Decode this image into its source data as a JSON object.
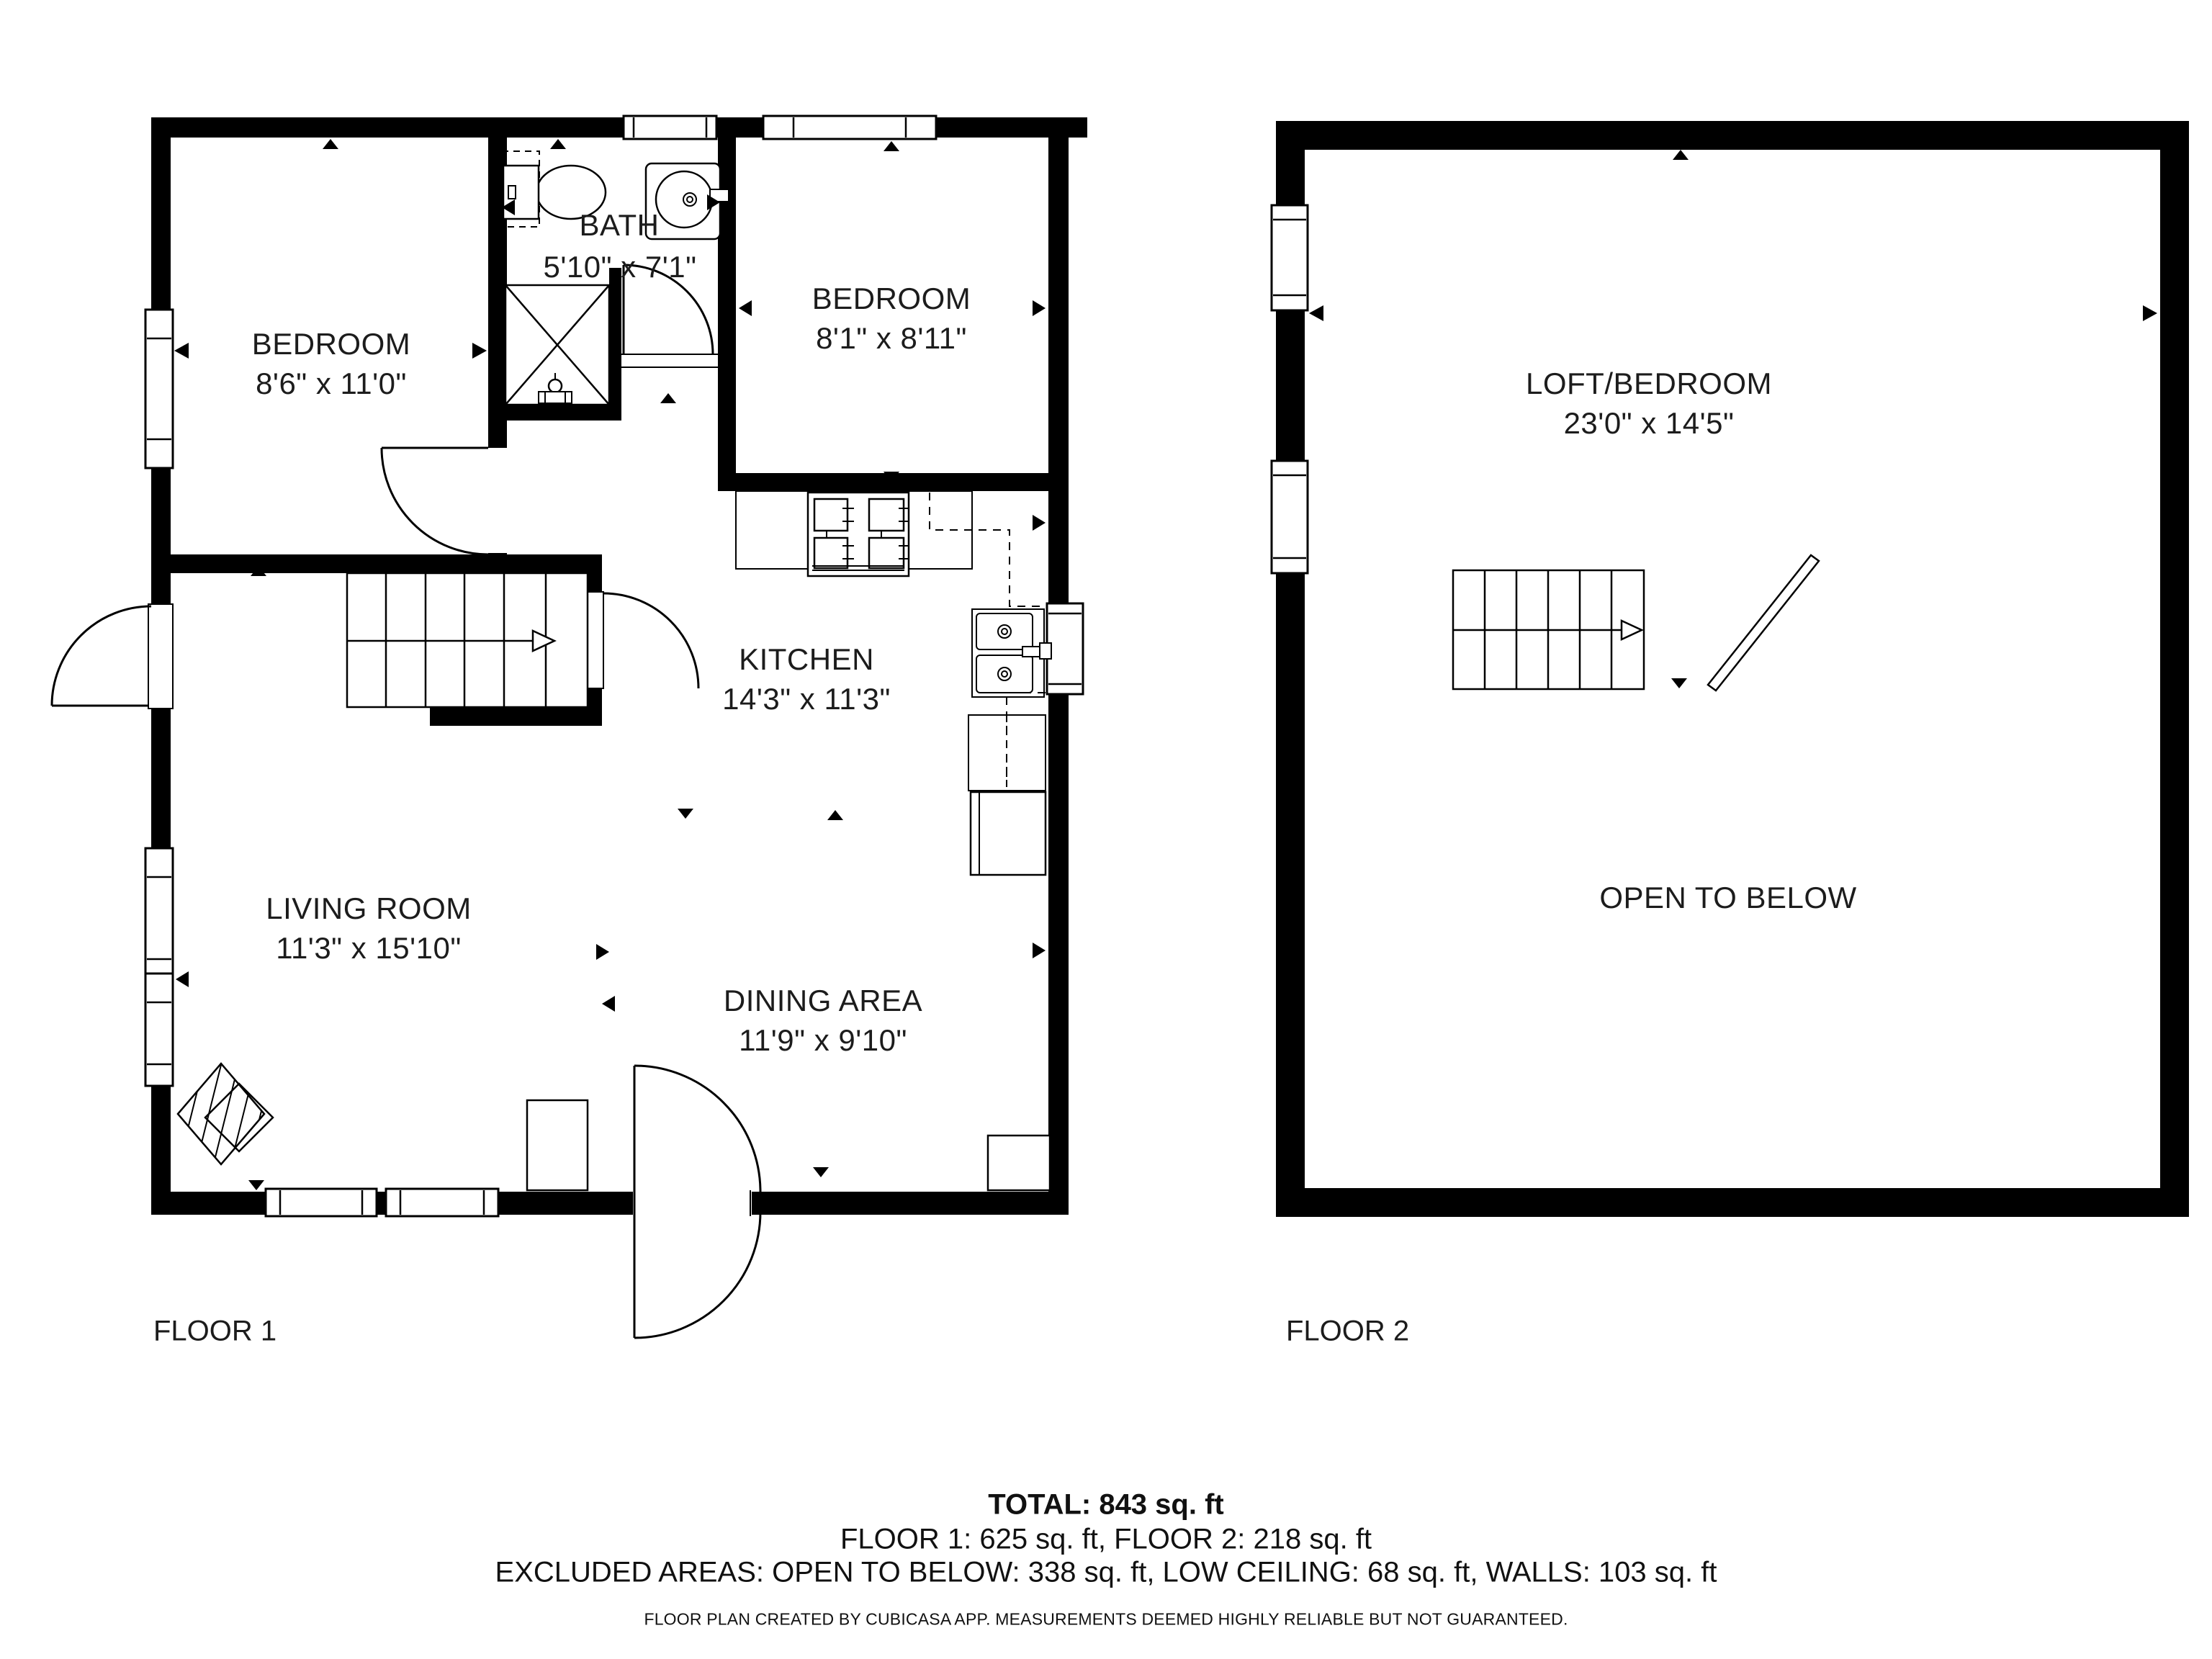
{
  "colors": {
    "wall": "#000000",
    "background": "#ffffff",
    "line": "#1c1c1c"
  },
  "floor1": {
    "label": "FLOOR 1",
    "rooms": {
      "bedroom1": {
        "name": "BEDROOM",
        "dims": "8'6\" x 11'0\""
      },
      "bath": {
        "name": "BATH",
        "dims": "5'10\" x 7'1\""
      },
      "bedroom2": {
        "name": "BEDROOM",
        "dims": "8'1\" x 8'11\""
      },
      "kitchen": {
        "name": "KITCHEN",
        "dims": "14'3\" x 11'3\""
      },
      "living": {
        "name": "LIVING ROOM",
        "dims": "11'3\" x 15'10\""
      },
      "dining": {
        "name": "DINING AREA",
        "dims": "11'9\" x 9'10\""
      }
    }
  },
  "floor2": {
    "label": "FLOOR 2",
    "rooms": {
      "loft": {
        "name": "LOFT/BEDROOM",
        "dims": "23'0\" x 14'5\""
      },
      "open_to_below": {
        "name": "OPEN TO BELOW"
      }
    }
  },
  "summary": {
    "total": "TOTAL: 843 sq. ft",
    "floors": "FLOOR 1: 625 sq. ft, FLOOR 2: 218 sq. ft",
    "excluded": "EXCLUDED AREAS: OPEN TO BELOW: 338 sq. ft, LOW CEILING: 68 sq. ft, WALLS: 103 sq. ft",
    "disclaimer": "FLOOR PLAN CREATED BY CUBICASA APP. MEASUREMENTS DEEMED HIGHLY RELIABLE BUT NOT GUARANTEED."
  }
}
